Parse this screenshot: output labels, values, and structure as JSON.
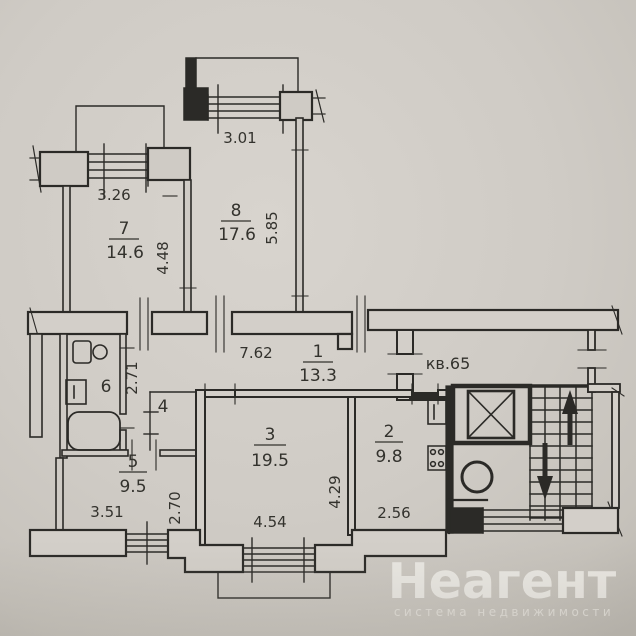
{
  "plan": {
    "apartment_label": "кв.65",
    "rooms": {
      "r1": {
        "number": "1",
        "area": "13.3"
      },
      "r2": {
        "number": "2",
        "area": "9.8"
      },
      "r3": {
        "number": "3",
        "area": "19.5"
      },
      "r4": {
        "number": "4"
      },
      "r5": {
        "number": "5",
        "area": "9.5"
      },
      "r6": {
        "number": "6"
      },
      "r7": {
        "number": "7",
        "area": "14.6"
      },
      "r8": {
        "number": "8",
        "area": "17.6"
      }
    },
    "dimensions": {
      "room8_width": "3.01",
      "room8_depth": "5.85",
      "room7_width": "3.26",
      "room7_depth": "4.48",
      "corridor_length": "7.62",
      "hall_depth": "2.71",
      "room5_width": "3.51",
      "room5_depth": "2.70",
      "room3_width": "4.54",
      "room3_depth": "4.29",
      "room2_width": "2.56"
    }
  },
  "watermark": {
    "brand": "Неагент",
    "tagline": "система недвижимости"
  },
  "colors": {
    "paper": "#cdc9c3",
    "ink": "#2b2a27",
    "watermark": "#eceae5"
  }
}
